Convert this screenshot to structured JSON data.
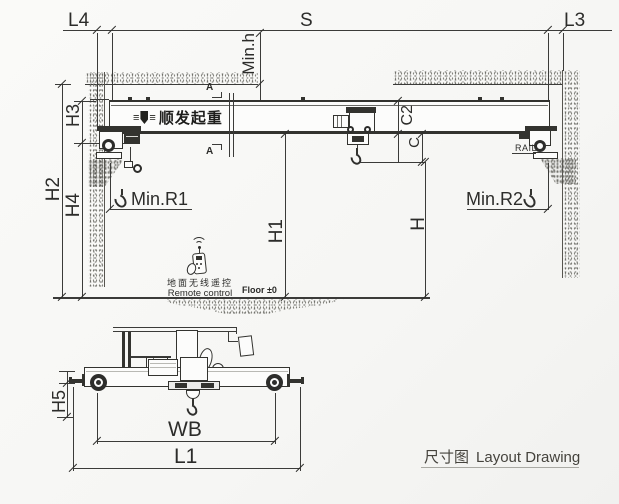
{
  "drawing": {
    "title_cn": "尺寸图",
    "title_en": "Layout Drawing",
    "brand_text": "顺发起重",
    "floor_label": "Floor ±0",
    "remote_label_cn": "地面无线遥控",
    "remote_label_en": "Remote control",
    "rail_label": "RAIL",
    "section_marker": "A"
  },
  "dimensions": {
    "top": {
      "l4": "L4",
      "s": "S",
      "l3": "L3",
      "min_h": "Min.h"
    },
    "left": {
      "h2": "H2",
      "h3": "H3",
      "h4": "H4"
    },
    "middle": {
      "c2": "C2",
      "c": "C",
      "h1": "H1",
      "h": "H",
      "min_r1": "Min.R1",
      "min_r2": "Min.R2"
    },
    "bottom": {
      "h5": "H5",
      "wb": "WB",
      "l1": "L1"
    }
  },
  "colors": {
    "line": "#3b3b39",
    "background": "#f7f7f5",
    "title_text": "#45433d"
  }
}
